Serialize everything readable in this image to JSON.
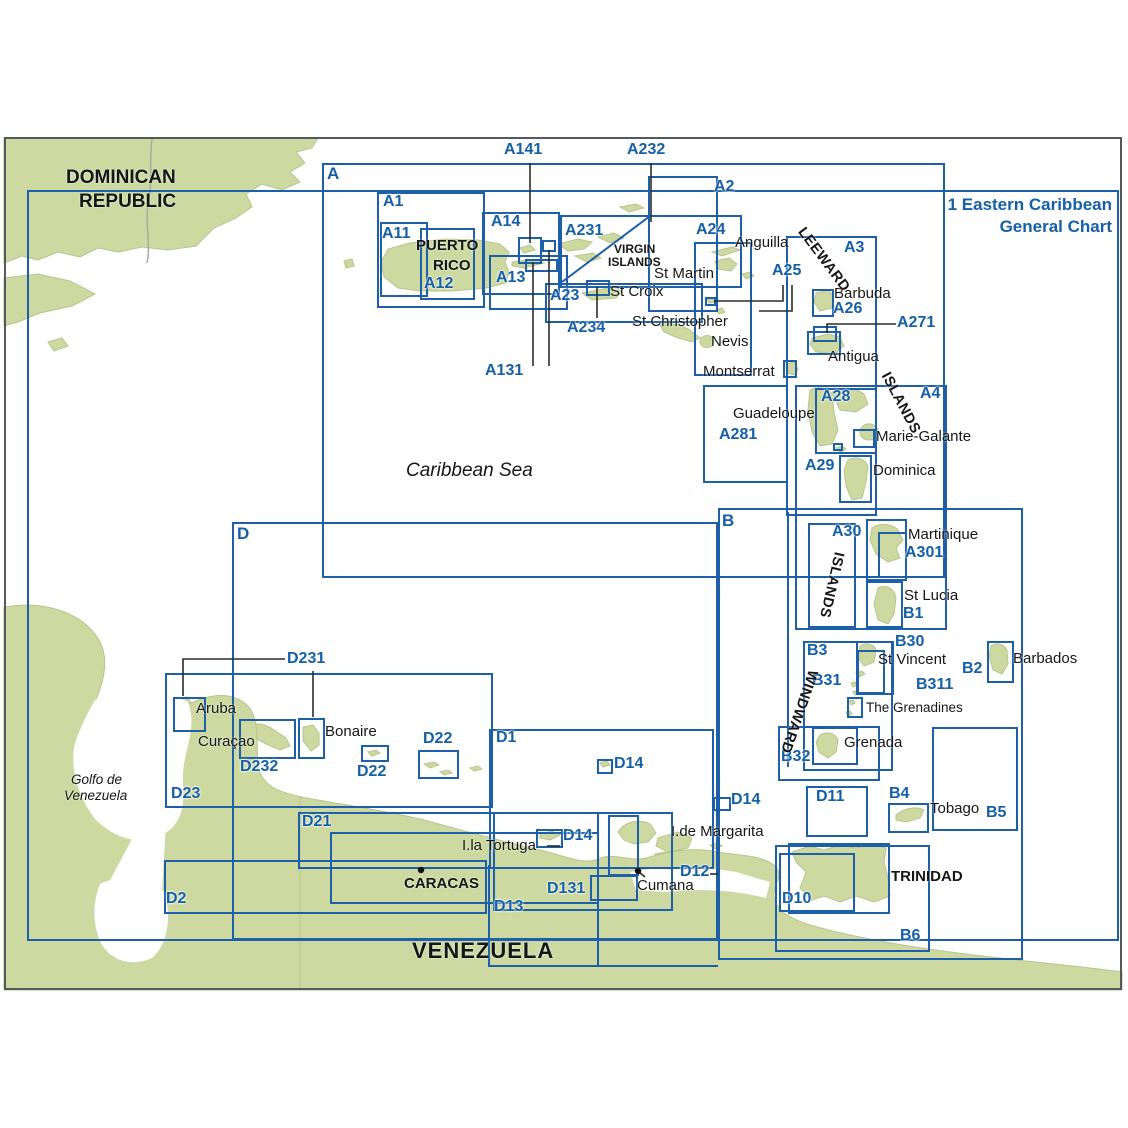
{
  "title": {
    "line1": "1 Eastern Caribbean",
    "line2": "General Chart"
  },
  "charts": {
    "a": "A",
    "a1": "A1",
    "a2": "A2",
    "a3": "A3",
    "a4": "A4",
    "a11": "A11",
    "a12": "A12",
    "a13": "A13",
    "a14": "A14",
    "a141": "A141",
    "a131": "A131",
    "a23": "A23",
    "a231": "A231",
    "a232": "A232",
    "a234": "A234",
    "a24": "A24",
    "a25": "A25",
    "a26": "A26",
    "a271": "A271",
    "a28": "A28",
    "a281": "A281",
    "a29": "A29",
    "a30": "A30",
    "a301": "A301",
    "b": "B",
    "b1": "B1",
    "b2": "B2",
    "b3": "B3",
    "b30": "B30",
    "b31": "B31",
    "b311": "B311",
    "b32": "B32",
    "b4": "B4",
    "b5": "B5",
    "b6": "B6",
    "d": "D",
    "d1": "D1",
    "d2": "D2",
    "d10": "D10",
    "d11": "D11",
    "d12": "D12",
    "d13": "D13",
    "d131": "D131",
    "d14": "D14",
    "d21": "D21",
    "d22": "D22",
    "d23": "D23",
    "d231": "D231",
    "d232": "D232"
  },
  "places": {
    "dominican_1": "DOMINICAN",
    "dominican_2": "REPUBLIC",
    "puerto_1": "PUERTO",
    "puerto_2": "RICO",
    "virgin_1": "VIRGIN",
    "virgin_2": "ISLANDS",
    "caribbean_sea": "Caribbean Sea",
    "anguilla": "Anguilla",
    "st_martin": "St Martin",
    "st_croix": "St Croix",
    "st_christopher": "St Christopher",
    "nevis": "Nevis",
    "barbuda": "Barbuda",
    "antigua": "Antigua",
    "montserrat": "Montserrat",
    "guadeloupe": "Guadeloupe",
    "marie_galante": "Marie-Galante",
    "dominica": "Dominica",
    "martinique": "Martinique",
    "st_lucia": "St Lucia",
    "st_vincent": "St Vincent",
    "barbados": "Barbados",
    "grenadines": "The Grenadines",
    "grenada": "Grenada",
    "tobago": "Tobago",
    "trinidad": "TRINIDAD",
    "aruba": "Aruba",
    "curacao": "Curaçao",
    "bonaire": "Bonaire",
    "tortuga": "I.la Tortuga",
    "margarita": "I.de Margarita",
    "cumana": "Cumana",
    "caracas": "CARACAS",
    "venezuela": "VENEZUELA",
    "golfo_1": "Golfo de",
    "golfo_2": "Venezuela",
    "leeward": "LEEWARD",
    "windward": "WINDWARD",
    "islands": "ISLANDS"
  },
  "colors": {
    "chart_line": "#1e5fa9",
    "label_blue": "#155fa8",
    "land": "#cdd9a1",
    "frame": "#55585c",
    "text": "#161616"
  }
}
